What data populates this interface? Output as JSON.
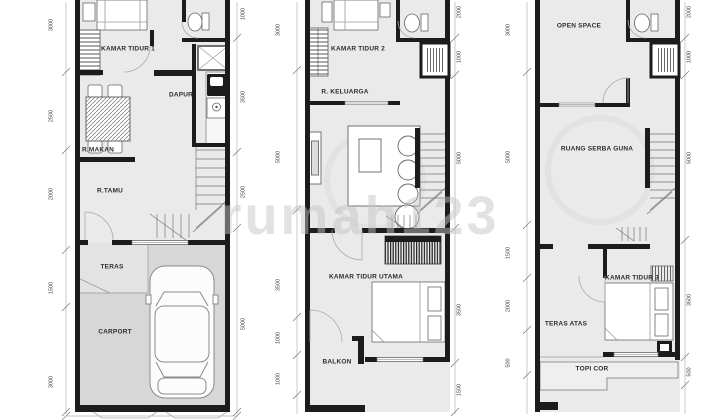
{
  "watermark": "rumah123",
  "colors": {
    "wall": "#1c1c1c",
    "floor": "#eaeaea",
    "carport_floor": "#d7d7d7",
    "teras_floor": "#e3e3e3",
    "dim_text": "#444444"
  },
  "plans": [
    {
      "id": "lantai-1",
      "rooms": [
        "KAMAR TIDUR 1",
        "DAPUR",
        "R.MAKAN",
        "R.TAMU",
        "TERAS",
        "CARPORT"
      ],
      "dims_left": [
        "3000",
        "2500",
        "2000",
        "1500",
        "3000"
      ],
      "dims_right": [
        "1000",
        "3500",
        "2500",
        "5000"
      ]
    },
    {
      "id": "lantai-2",
      "rooms": [
        "KAMAR TIDUR 2",
        "R. KELUARGA",
        "KAMAR TIDUR UTAMA",
        "BALKON"
      ],
      "dims_left": [
        "3000",
        "5000",
        "3500",
        "1000",
        "1000"
      ],
      "dims_right": [
        "2000",
        "1000",
        "5000",
        "3500",
        "1500"
      ]
    },
    {
      "id": "lantai-3",
      "rooms": [
        "OPEN SPACE",
        "RUANG SERBA GUNA",
        "KAMAR TIDUR 3",
        "TERAS ATAS",
        "TOPI COR"
      ],
      "dims_left": [
        "3000",
        "5000",
        "1500",
        "2000",
        "500"
      ],
      "dims_right": [
        "2000",
        "1000",
        "5000",
        "3500",
        "500"
      ]
    }
  ]
}
